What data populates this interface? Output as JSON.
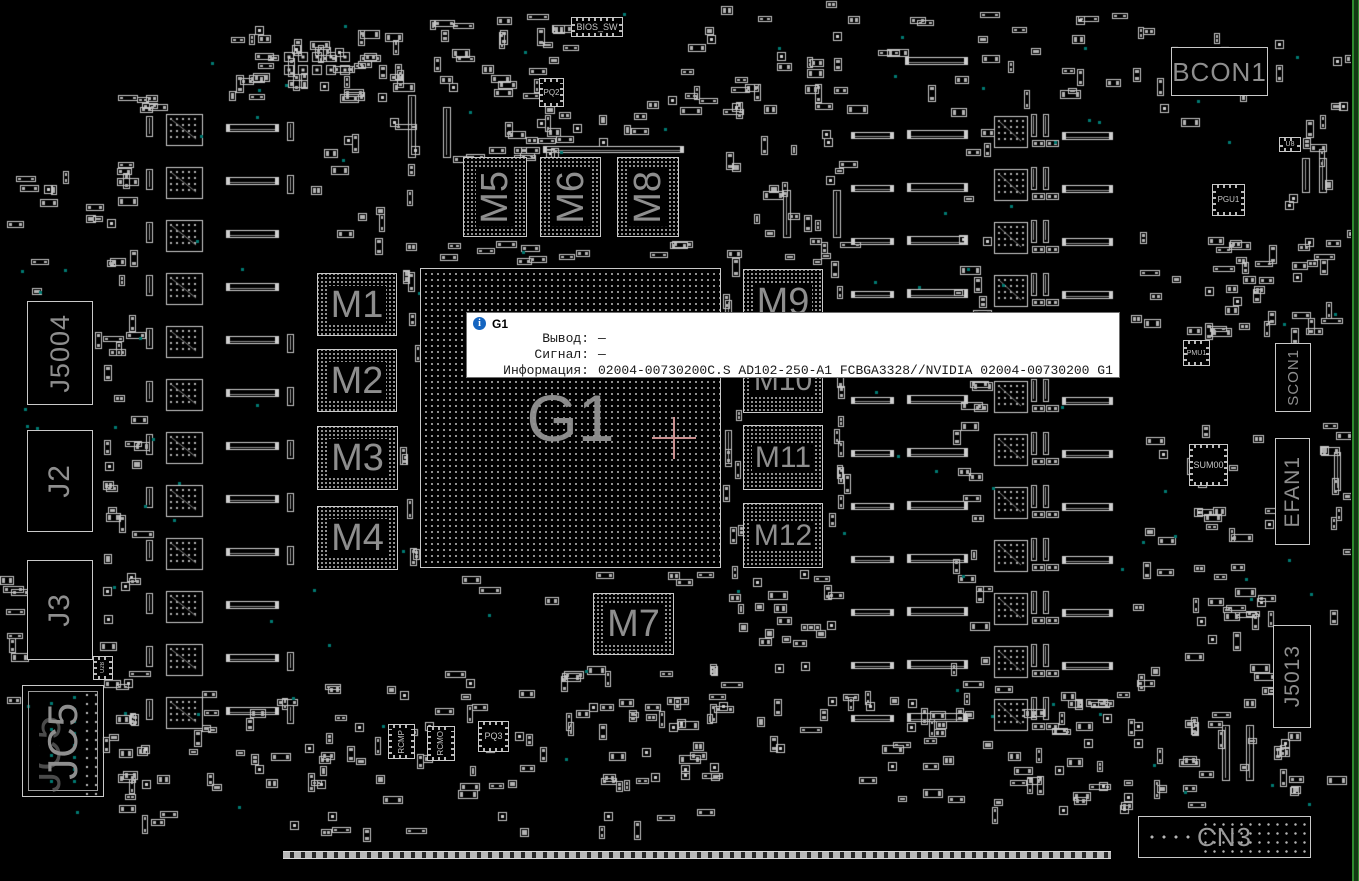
{
  "tooltip": {
    "icon": "info-icon",
    "title": "G1",
    "rows": [
      {
        "label": "Вывод:",
        "value": "—"
      },
      {
        "label": "Сигнал:",
        "value": "—"
      },
      {
        "label": "Информация:",
        "value": "02004-00730200C.S AD102-250-A1 FCBGA3328//NVIDIA 02004-00730200 G1"
      }
    ]
  },
  "components": {
    "g1": "G1",
    "m1": "M1",
    "m2": "M2",
    "m3": "M3",
    "m4": "M4",
    "m5": "M5",
    "m6": "M6",
    "m7": "M7",
    "m8": "M8",
    "m9": "M9",
    "m10": "M10",
    "m11": "M11",
    "m12": "M12",
    "bcon1": "BCON1",
    "j5004": "J5004",
    "j2": "J2",
    "j3": "J3",
    "jc5": "JC5",
    "cn3": "CN3",
    "scon1": "SCON1",
    "efan1": "EFAN1",
    "j5013": "J5013",
    "pgu1": "PGU1",
    "pmu1": "PMU1",
    "sum00": "SUM00",
    "u8": "U8",
    "u28": "U28",
    "pq2": "PQ2",
    "pq3": "PQ3",
    "rcmp": "RCMP",
    "rcmo": "RCMO",
    "bios_sw": "BIOS_SW"
  },
  "colors": {
    "background": "#000000",
    "silkscreen": "#c8c8c8",
    "component_label": "#8e8e8e",
    "test_point": "#007a72",
    "crosshair": "#c98e8e",
    "tooltip_info_icon": "#1565c0",
    "board_edge": "#2e8b2e"
  }
}
